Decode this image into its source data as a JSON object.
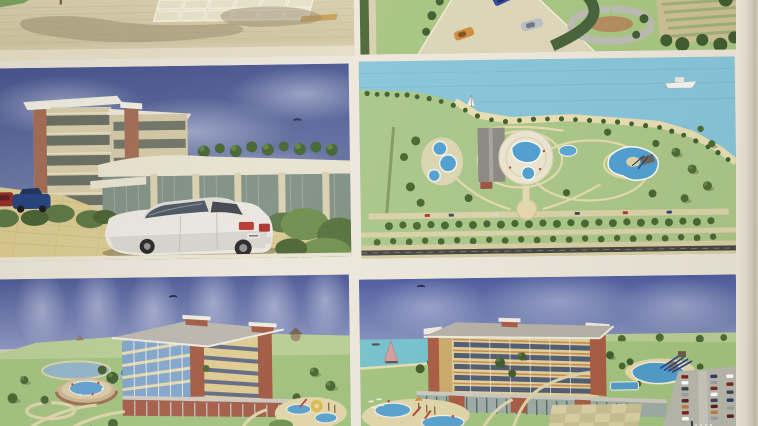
{
  "photo": {
    "description": "Photograph of a printed presentation sheet with six architectural concept renderings of a seaside hotel and aquapark resort, arranged in a two-column grid on warm white paper with a bare paper margin on the right",
    "panels": [
      {
        "id": "plaza-aerial",
        "description": "Cropped aerial rendering of a paved plaza: beige brick paving, inlaid grid of light tiles, tree shadows falling across the pavement and a grass verge with a slender pole at the top left"
      },
      {
        "id": "access-road-aerial",
        "description": "Cropped aerial rendering of a landscaped access road with a blue, an orange and a silver car, curved dark hedges, rows of planted terraces and shrubbery on the right"
      },
      {
        "id": "hotel-street-view",
        "description": "Street-level rendering under a deep blue cloudy sky: five-storey hotel with cream facade, red brick towers, curved glass pavilion and roof-garden trees; a large white sedan parked on yellow paving in the foreground, dark blue and red cars at the left edge, green hedges between"
      },
      {
        "id": "resort-master-plan",
        "description": "Aerial master-plan rendering: light blue sea with a white ship and a small sailboat, tree-lined beach, lawns with looping beige paths, a circular pool complex, round pools, a free-form lagoon pool, a long grey-roofed building, a circular plaza and tree-lined access roads with a dark asphalt road at the bottom"
      },
      {
        "id": "resort-birdseye-sea-side",
        "description": "Bird's-eye rendering under a streaked blue sky: five-storey hotel with blue glass balconies, brick corner towers and grey hipped roof, a low brick colonnade wing, a round pool terrace, a lake, rolling lawns with paths, scattered trees and a children's water playground at the lower right"
      },
      {
        "id": "resort-birdseye-land-side",
        "description": "Bird's-eye rendering from the land side: the hotel with balcony facade and colonnade wing, a lagoon pool with dark water slides, a large car park with rows of parked cars, checkered paved plazas, a children's water play area at the lower left and the turquoise sea with a pink sail on the horizon"
      }
    ],
    "palette": {
      "paper": "#e9e3d7",
      "paper_edge_shadow": "#c4bcab",
      "sky_deep_blue": "#4b5795",
      "sky_horizon": "#8a94bf",
      "sea_plan_blue": "#85c3d7",
      "sea_turquoise": "#74c1cb",
      "lawn_green": "#a2c27e",
      "plan_green": "#a9c587",
      "tree_green": "#46642f",
      "paving_beige": "#d7cda9",
      "parking_yellow": "#d8c88e",
      "pool_blue": "#4f9fd0",
      "brick_red": "#a55a43",
      "facade_cream": "#d6cba8",
      "facade_yellow": "#dcc98e",
      "roof_grey": "#b5b1a8",
      "asphalt": "#46443f",
      "car_white": "#e9e6e0",
      "car_blue": "#23407c",
      "car_red": "#8e2a26",
      "car_orange": "#cf8a3c",
      "car_silver": "#b9bcc4",
      "sail_pink": "#cf9f9e"
    }
  }
}
